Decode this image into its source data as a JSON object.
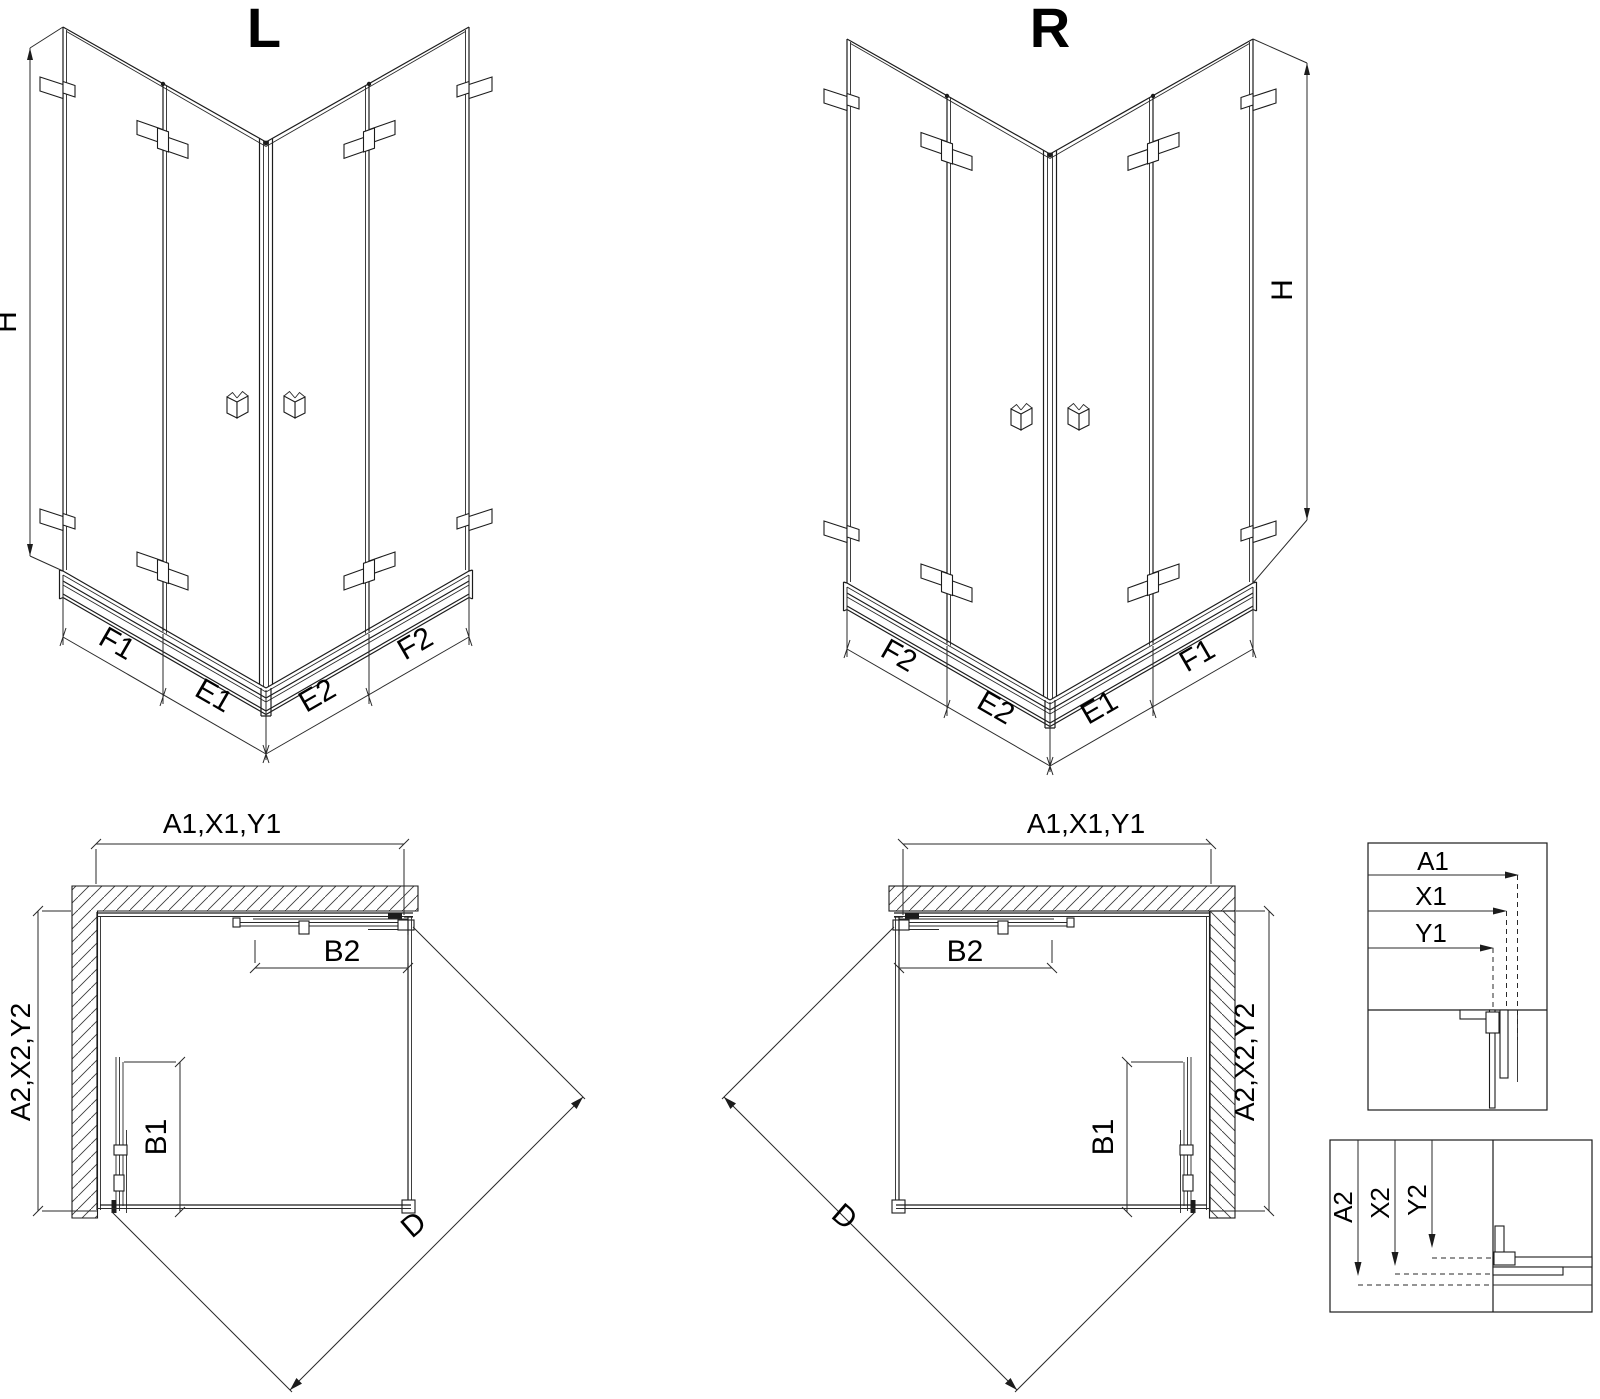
{
  "drawing": {
    "iso_left": {
      "title": "L",
      "height": "H",
      "seg_left_outer": "F1",
      "seg_left_inner": "E1",
      "seg_right_inner": "E2",
      "seg_right_outer": "F2"
    },
    "iso_right": {
      "title": "R",
      "height": "H",
      "seg_left_outer": "F2",
      "seg_left_inner": "E2",
      "seg_right_inner": "E1",
      "seg_right_outer": "F1"
    },
    "plan_left": {
      "width": "A1,X1,Y1",
      "depth": "A2,X2,Y2",
      "door_top": "B2",
      "door_side": "B1",
      "diagonal": "D"
    },
    "plan_right": {
      "width": "A1,X1,Y1",
      "depth": "A2,X2,Y2",
      "door_top": "B2",
      "door_side": "B1",
      "diagonal": "D"
    },
    "detail_width": {
      "dim1": "A1",
      "dim2": "X1",
      "dim3": "Y1"
    },
    "detail_depth": {
      "dim1": "A2",
      "dim2": "X2",
      "dim3": "Y2"
    }
  }
}
